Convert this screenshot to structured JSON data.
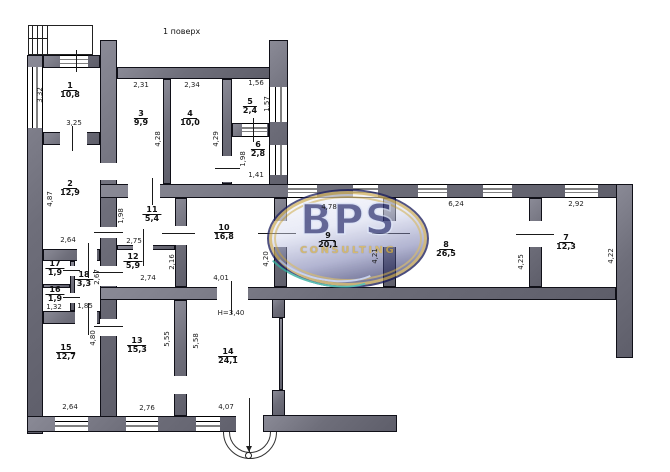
{
  "title": "1 поверх",
  "logo": {
    "brand": "BPS",
    "subtitle": "CONSULTING",
    "x": 267,
    "y": 189,
    "w": 162,
    "h": 99,
    "colors": {
      "navy": "#161848",
      "gold": "#c9a64a",
      "teal": "#2fae9e",
      "light": "#d6def6"
    }
  },
  "wall_color": "#6e6e7a",
  "rooms": [
    {
      "number": "1",
      "area": "10,8",
      "x": 70,
      "y": 82
    },
    {
      "number": "2",
      "area": "12,9",
      "x": 70,
      "y": 180
    },
    {
      "number": "3",
      "area": "9,9",
      "x": 141,
      "y": 110
    },
    {
      "number": "4",
      "area": "10,0",
      "x": 190,
      "y": 110
    },
    {
      "number": "5",
      "area": "2,4",
      "x": 250,
      "y": 98
    },
    {
      "number": "6",
      "area": "2,8",
      "x": 258,
      "y": 141
    },
    {
      "number": "7",
      "area": "12,3",
      "x": 566,
      "y": 234
    },
    {
      "number": "8",
      "area": "26,5",
      "x": 446,
      "y": 241
    },
    {
      "number": "9",
      "area": "20,1",
      "x": 328,
      "y": 232
    },
    {
      "number": "10",
      "area": "16,8",
      "x": 224,
      "y": 224
    },
    {
      "number": "11",
      "area": "5,4",
      "x": 152,
      "y": 206
    },
    {
      "number": "12",
      "area": "5,9",
      "x": 133,
      "y": 253
    },
    {
      "number": "13",
      "area": "15,3",
      "x": 137,
      "y": 337
    },
    {
      "number": "14",
      "area": "24,1",
      "x": 228,
      "y": 348
    },
    {
      "number": "15",
      "area": "12,7",
      "x": 66,
      "y": 344
    },
    {
      "number": "16",
      "area": "1,9",
      "x": 55,
      "y": 286
    },
    {
      "number": "17",
      "area": "1,9",
      "x": 55,
      "y": 260
    },
    {
      "number": "18",
      "area": "3,3",
      "x": 84,
      "y": 271
    }
  ],
  "dims_h": [
    {
      "text": "2,31",
      "x": 141,
      "y": 81
    },
    {
      "text": "2,34",
      "x": 192,
      "y": 81
    },
    {
      "text": "1,56",
      "x": 256,
      "y": 79
    },
    {
      "text": "3,25",
      "x": 74,
      "y": 119
    },
    {
      "text": "1,41",
      "x": 256,
      "y": 171
    },
    {
      "text": "2,64",
      "x": 68,
      "y": 236
    },
    {
      "text": "2,75",
      "x": 134,
      "y": 237
    },
    {
      "text": "2,74",
      "x": 148,
      "y": 274
    },
    {
      "text": "4,01",
      "x": 221,
      "y": 274
    },
    {
      "text": "H=3,40",
      "x": 231,
      "y": 309
    },
    {
      "text": "1,32",
      "x": 54,
      "y": 303
    },
    {
      "text": "1,85",
      "x": 85,
      "y": 302
    },
    {
      "text": "4,78",
      "x": 329,
      "y": 203
    },
    {
      "text": "6,24",
      "x": 456,
      "y": 200
    },
    {
      "text": "2,92",
      "x": 576,
      "y": 200
    },
    {
      "text": "2,64",
      "x": 70,
      "y": 403
    },
    {
      "text": "2,76",
      "x": 147,
      "y": 404
    },
    {
      "text": "4,07",
      "x": 226,
      "y": 403
    }
  ],
  "dims_v": [
    {
      "text": "3,32",
      "x": 40,
      "y": 95
    },
    {
      "text": "4,87",
      "x": 50,
      "y": 199
    },
    {
      "text": "4,28",
      "x": 158,
      "y": 139
    },
    {
      "text": "4,29",
      "x": 216,
      "y": 139
    },
    {
      "text": "1,57",
      "x": 267,
      "y": 104
    },
    {
      "text": "1,98",
      "x": 243,
      "y": 159
    },
    {
      "text": "1,98",
      "x": 121,
      "y": 216
    },
    {
      "text": "2,16",
      "x": 172,
      "y": 262
    },
    {
      "text": "2,67",
      "x": 97,
      "y": 277
    },
    {
      "text": "4,20",
      "x": 266,
      "y": 259
    },
    {
      "text": "4,21",
      "x": 375,
      "y": 256
    },
    {
      "text": "4,25",
      "x": 521,
      "y": 262
    },
    {
      "text": "4,22",
      "x": 611,
      "y": 256
    },
    {
      "text": "5,55",
      "x": 167,
      "y": 339
    },
    {
      "text": "5,58",
      "x": 196,
      "y": 341
    },
    {
      "text": "4,80",
      "x": 93,
      "y": 338
    }
  ],
  "walls": [
    {
      "x": 27,
      "y": 55,
      "w": 16,
      "h": 379
    },
    {
      "x": 43,
      "y": 55,
      "w": 57,
      "h": 13
    },
    {
      "x": 43,
      "y": 132,
      "w": 57,
      "h": 13
    },
    {
      "x": 43,
      "y": 249,
      "w": 57,
      "h": 12
    },
    {
      "x": 43,
      "y": 284,
      "w": 27,
      "h": 4
    },
    {
      "x": 70,
      "y": 261,
      "w": 5,
      "h": 50
    },
    {
      "x": 43,
      "y": 311,
      "w": 57,
      "h": 13
    },
    {
      "x": 100,
      "y": 40,
      "w": 17,
      "h": 377
    },
    {
      "x": 27,
      "y": 416,
      "w": 236,
      "h": 16
    },
    {
      "x": 263,
      "y": 415,
      "w": 134,
      "h": 17
    },
    {
      "x": 117,
      "y": 67,
      "w": 153,
      "h": 12
    },
    {
      "x": 269,
      "y": 40,
      "w": 19,
      "h": 158
    },
    {
      "x": 163,
      "y": 79,
      "w": 8,
      "h": 105
    },
    {
      "x": 222,
      "y": 79,
      "w": 10,
      "h": 105
    },
    {
      "x": 232,
      "y": 123,
      "w": 37,
      "h": 14
    },
    {
      "x": 100,
      "y": 184,
      "w": 533,
      "h": 14
    },
    {
      "x": 616,
      "y": 184,
      "w": 17,
      "h": 174
    },
    {
      "x": 100,
      "y": 287,
      "w": 516,
      "h": 13
    },
    {
      "x": 175,
      "y": 198,
      "w": 12,
      "h": 89
    },
    {
      "x": 117,
      "y": 245,
      "w": 58,
      "h": 5
    },
    {
      "x": 274,
      "y": 198,
      "w": 13,
      "h": 89
    },
    {
      "x": 383,
      "y": 198,
      "w": 13,
      "h": 89
    },
    {
      "x": 529,
      "y": 198,
      "w": 13,
      "h": 89
    },
    {
      "x": 174,
      "y": 300,
      "w": 13,
      "h": 116
    },
    {
      "x": 272,
      "y": 299,
      "w": 13,
      "h": 19
    },
    {
      "x": 272,
      "y": 390,
      "w": 13,
      "h": 26
    },
    {
      "x": 279,
      "y": 318,
      "w": 4,
      "h": 72
    }
  ],
  "windows": [
    {
      "x": 27,
      "y": 67,
      "w": 16,
      "h": 61,
      "dir": "v"
    },
    {
      "x": 60,
      "y": 55,
      "w": 28,
      "h": 13,
      "dir": "h"
    },
    {
      "x": 55,
      "y": 416,
      "w": 33,
      "h": 16,
      "dir": "h"
    },
    {
      "x": 126,
      "y": 416,
      "w": 32,
      "h": 16,
      "dir": "h"
    },
    {
      "x": 196,
      "y": 416,
      "w": 24,
      "h": 16,
      "dir": "h"
    },
    {
      "x": 269,
      "y": 87,
      "w": 19,
      "h": 35,
      "dir": "v"
    },
    {
      "x": 269,
      "y": 145,
      "w": 19,
      "h": 30,
      "dir": "v"
    },
    {
      "x": 288,
      "y": 184,
      "w": 29,
      "h": 14,
      "dir": "h"
    },
    {
      "x": 353,
      "y": 184,
      "w": 25,
      "h": 14,
      "dir": "h"
    },
    {
      "x": 418,
      "y": 184,
      "w": 29,
      "h": 14,
      "dir": "h"
    },
    {
      "x": 483,
      "y": 184,
      "w": 29,
      "h": 14,
      "dir": "h"
    },
    {
      "x": 565,
      "y": 184,
      "w": 33,
      "h": 14,
      "dir": "h"
    },
    {
      "x": 242,
      "y": 123,
      "w": 25,
      "h": 14,
      "dir": "h"
    }
  ],
  "doors": [
    {
      "x": 60,
      "y": 132,
      "w": 27,
      "h": 13
    },
    {
      "x": 100,
      "y": 163,
      "w": 17,
      "h": 17
    },
    {
      "x": 100,
      "y": 227,
      "w": 17,
      "h": 11
    },
    {
      "x": 100,
      "y": 266,
      "w": 17,
      "h": 20
    },
    {
      "x": 100,
      "y": 319,
      "w": 17,
      "h": 17
    },
    {
      "x": 77,
      "y": 249,
      "w": 20,
      "h": 12
    },
    {
      "x": 70,
      "y": 266,
      "w": 5,
      "h": 10
    },
    {
      "x": 70,
      "y": 293,
      "w": 5,
      "h": 10
    },
    {
      "x": 75,
      "y": 311,
      "w": 22,
      "h": 13
    },
    {
      "x": 128,
      "y": 184,
      "w": 32,
      "h": 14
    },
    {
      "x": 133,
      "y": 245,
      "w": 20,
      "h": 5
    },
    {
      "x": 175,
      "y": 226,
      "w": 12,
      "h": 19
    },
    {
      "x": 222,
      "y": 156,
      "w": 10,
      "h": 26
    },
    {
      "x": 217,
      "y": 287,
      "w": 31,
      "h": 13
    },
    {
      "x": 274,
      "y": 221,
      "w": 13,
      "h": 26
    },
    {
      "x": 383,
      "y": 221,
      "w": 13,
      "h": 26
    },
    {
      "x": 529,
      "y": 221,
      "w": 13,
      "h": 26
    },
    {
      "x": 174,
      "y": 376,
      "w": 13,
      "h": 18
    },
    {
      "x": 236,
      "y": 416,
      "w": 27,
      "h": 16
    }
  ],
  "ticks": [
    {
      "x": 258,
      "y": 233,
      "w": 38,
      "h": 1
    },
    {
      "x": 372,
      "y": 233,
      "w": 38,
      "h": 1
    },
    {
      "x": 516,
      "y": 234,
      "w": 38,
      "h": 1
    },
    {
      "x": 88,
      "y": 243,
      "w": 1,
      "h": 35
    },
    {
      "x": 88,
      "y": 303,
      "w": 1,
      "h": 32
    },
    {
      "x": 72,
      "y": 126,
      "w": 1,
      "h": 25
    },
    {
      "x": 76,
      "y": 50,
      "w": 1,
      "h": 22
    },
    {
      "x": 152,
      "y": 178,
      "w": 1,
      "h": 27
    },
    {
      "x": 143,
      "y": 229,
      "w": 1,
      "h": 37
    },
    {
      "x": 231,
      "y": 281,
      "w": 1,
      "h": 33
    },
    {
      "x": 162,
      "y": 233,
      "w": 33,
      "h": 1
    },
    {
      "x": 94,
      "y": 232,
      "w": 29,
      "h": 1
    },
    {
      "x": 93,
      "y": 272,
      "w": 30,
      "h": 1
    },
    {
      "x": 94,
      "y": 326,
      "w": 29,
      "h": 1
    },
    {
      "x": 63,
      "y": 270,
      "w": 17,
      "h": 1
    },
    {
      "x": 63,
      "y": 297,
      "w": 17,
      "h": 1
    },
    {
      "x": 253,
      "y": 118,
      "w": 1,
      "h": 24
    },
    {
      "x": 215,
      "y": 168,
      "w": 25,
      "h": 1
    },
    {
      "x": 29,
      "y": 38,
      "w": 18,
      "h": 1
    }
  ],
  "porch": {
    "x": 28,
    "y": 25,
    "w": 65,
    "h": 30,
    "hatch_x": [
      32,
      37,
      42,
      47
    ]
  },
  "entrance": {
    "arcs": [
      {
        "x": 223,
        "y": 405,
        "d": 54
      },
      {
        "x": 229,
        "y": 411,
        "d": 42
      }
    ],
    "axis": {
      "x": 249,
      "y": 398,
      "h": 54
    },
    "circle": {
      "x": 245,
      "y": 452,
      "d": 7
    }
  }
}
